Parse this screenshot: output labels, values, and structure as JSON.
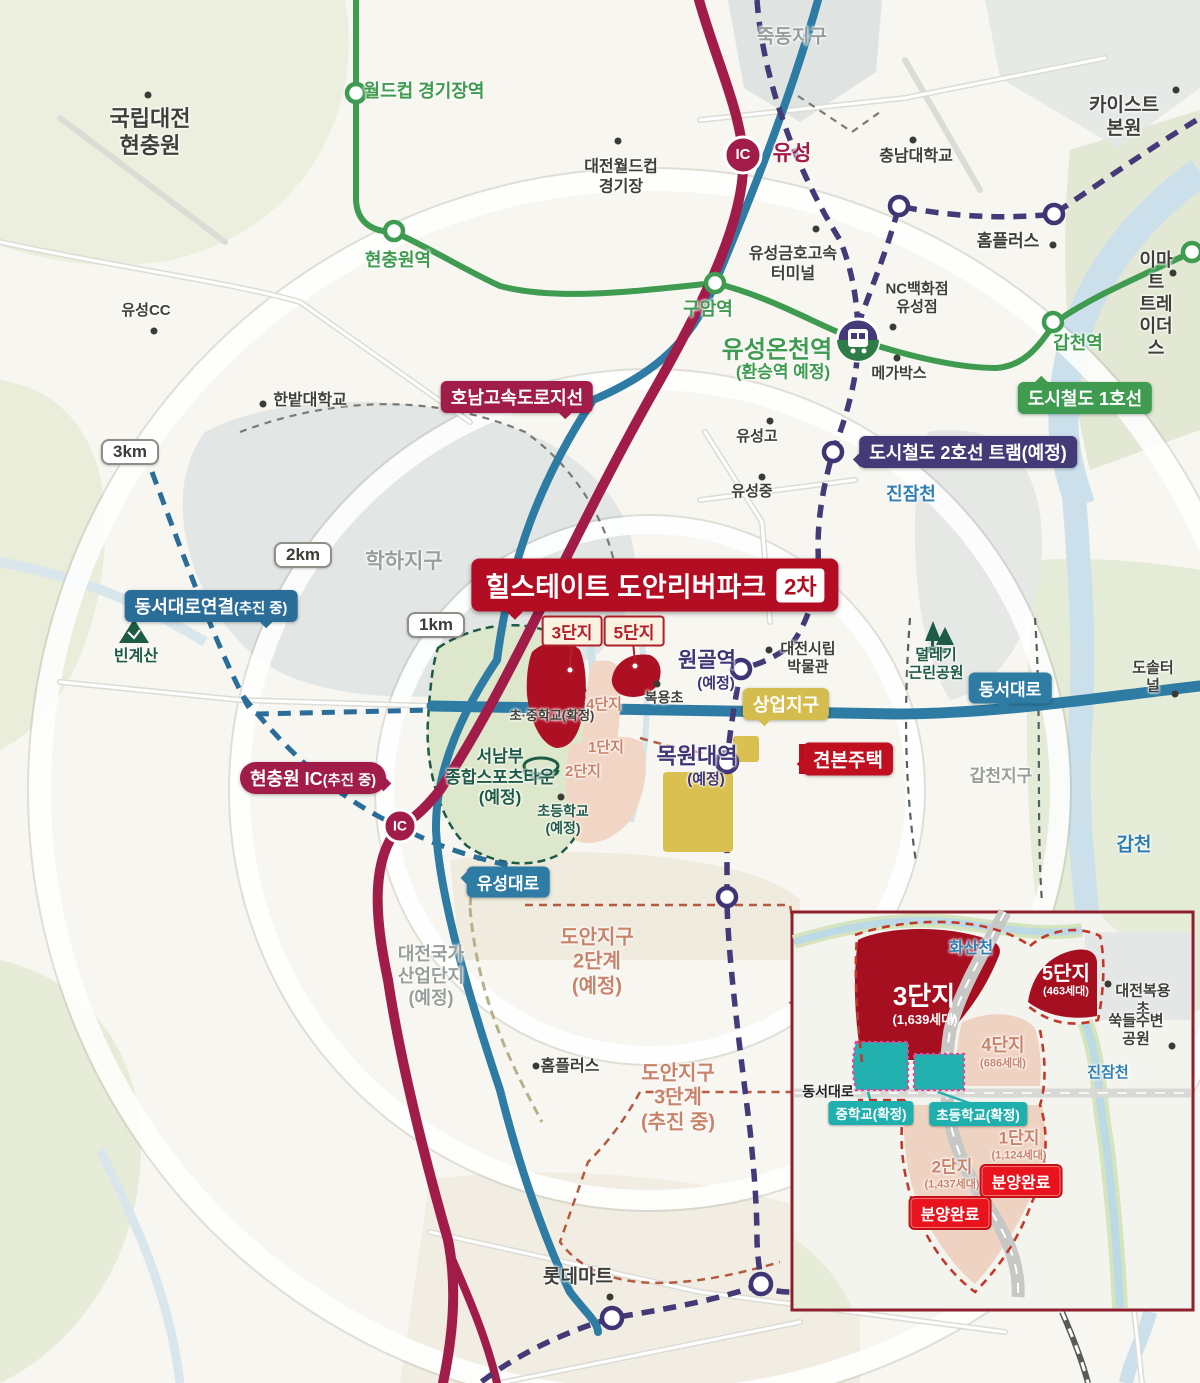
{
  "labels": {
    "njc": "국립대전\n현충원",
    "jukdong": "죽동지구",
    "worldcup_station": "월드컵 경기장역",
    "worldcup_stadium": "대전월드컵\n경기장",
    "ic_yuseong_ic": "IC",
    "ic_yuseong": "유성",
    "kaist": "카이스트 본원",
    "cnu": "충남대학교",
    "homeplus_top": "홈플러스",
    "emart": "이마트\n트레이더스",
    "gapcheon_station": "갑천역",
    "line1_badge": "도시철도 1호선",
    "terminal": "유성금호고속\n터미널",
    "hyeonchungwon_station": "현충원역",
    "guam_station": "구암역",
    "yuseong_oncheon": "유성온천역",
    "yuseong_oncheon_sub": "(환승역 예정)",
    "nc_dept": "NC백화점\n유성점",
    "megabox": "메가박스",
    "yuseong_go": "유성고",
    "yuseong_jung": "유성중",
    "tram_badge": "도시철도 2호선 트램(예정)",
    "jinjamcheon": "진잠천",
    "honam_badge": "호남고속도로지선",
    "hanbat": "한밭대학교",
    "r3": "3km",
    "r2": "2km",
    "r1": "1km",
    "hakha": "학하지구",
    "dongseo_connect": "동서대로연결",
    "dongseo_connect_sub": "(추진 중)",
    "bingyesan": "빈계산",
    "yuseong_cc": "유성CC",
    "title_main": "힐스테이트 도안리버파크",
    "title_phase": "2차",
    "c3": "3단지",
    "c5": "5단지",
    "bokyongcho": "복용초",
    "wongol": "원골역",
    "wongol_sub": "(예정)",
    "museum": "대전시립\n박물관",
    "sangeop_badge": "상업지구",
    "deollegi": "덜레기\n근린공원",
    "dongseo_badge": "동서대로",
    "dosol": "도솔터널",
    "mokwon": "목원대역",
    "mokwon_sub": "(예정)",
    "gyeonbon_badge": "견본주택",
    "gapcheon_district": "갑천지구",
    "gapcheon": "갑천",
    "hc_ic": "현충원 IC",
    "hc_ic_sub": "(추진 중)",
    "hc_ic_circle": "IC",
    "sports": "서남부\n종합스포츠타운\n(예정)",
    "elementary_planned": "초등학교\n(예정)",
    "school_confirmed": "초·중학교(확정)",
    "c4": "4단지",
    "c1": "1단지",
    "c2": "2단지",
    "yuseongdaero_badge": "유성대로",
    "doan2": "도안지구\n2단계\n(예정)",
    "industrial": "대전국가\n산업단지\n(예정)",
    "homeplus_bottom": "홈플러스",
    "doan3": "도안지구\n3단계\n(추진 중)",
    "lotte": "롯데마트"
  },
  "inset": {
    "hwasancheon": "화산천",
    "c3": "3단지",
    "c3_units": "(1,639세대)",
    "c5": "5단지",
    "c5_units": "(463세대)",
    "bokyong_elem": "대전복용초",
    "ssukdeul": "쑥들수변공원",
    "c4": "4단지",
    "c4_units": "(686세대)",
    "jinjamcheon": "진잠천",
    "dongseo": "동서대로",
    "middle_school": "중학교(확정)",
    "elem_school": "초등학교(확정)",
    "c1": "1단지",
    "c1_units": "(1,124세대)",
    "c2": "2단지",
    "c2_units": "(1,437세대)",
    "soldout1": "분양완료",
    "soldout2": "분양완료"
  },
  "colors": {
    "brand_red": "#b20d23",
    "expressway_maroon": "#a21c4a",
    "line1_green": "#3e9b4f",
    "tram_navy": "#443a78",
    "road_teal": "#2e7ca3",
    "connect_blue": "#2a6d99",
    "commercial_yellow": "#d5bc4e",
    "site_red": "#a50f20",
    "block_pink": "#efd3c2",
    "school_teal": "#1fb0ad",
    "soldout_red": "#e8131c"
  }
}
